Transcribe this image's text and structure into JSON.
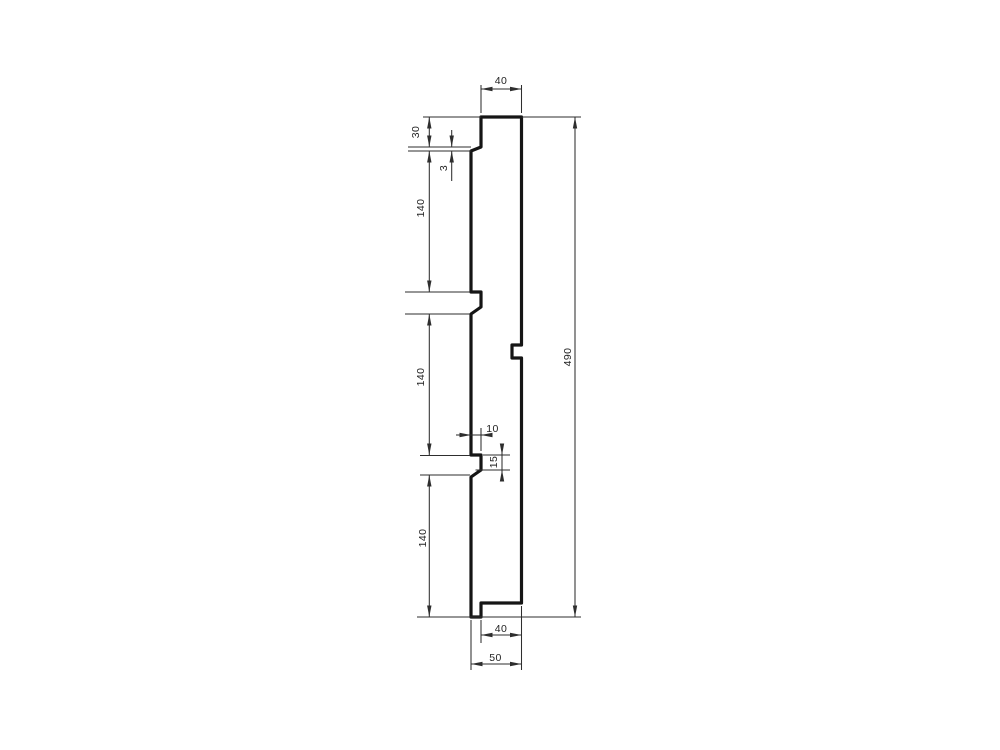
{
  "page": {
    "background": "#ffffff",
    "line_color": "#2e2e2e",
    "profile_color": "#151515"
  },
  "drawing": {
    "type": "technical-cross-section",
    "subject": "vertical panel profile with three grooves, top cap and bottom rebate",
    "dimensions": {
      "top_width": "40",
      "cap_height": "30",
      "cap_undercut": "3",
      "segment_upper": "140",
      "segment_middle": "140",
      "segment_lower": "140",
      "groove_depth": "10",
      "groove_height": "15",
      "overall_height": "490",
      "bottom_rebate_width": "40",
      "overall_width": "50"
    }
  }
}
